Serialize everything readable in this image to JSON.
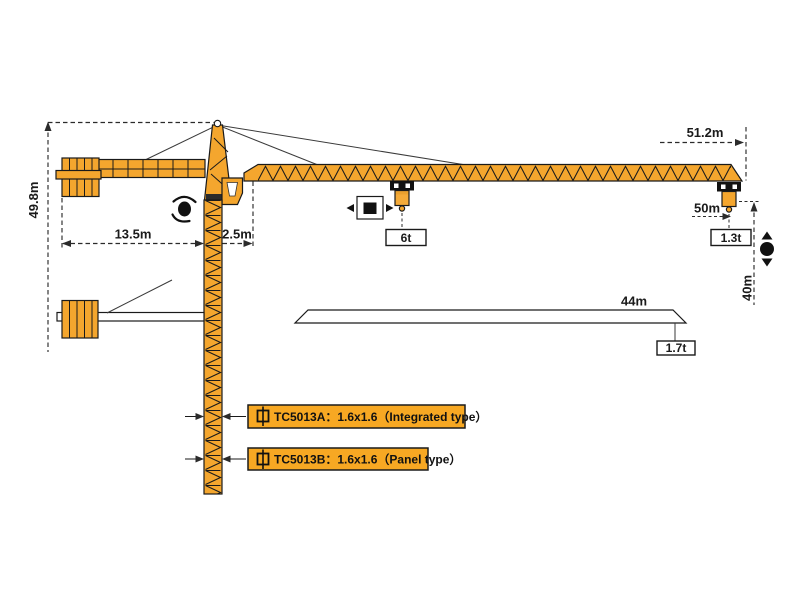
{
  "colors": {
    "crane": "#F4A62E",
    "outline": "#1A1A1A",
    "dim": "#2B2B2B",
    "label_bg": "#F7A823"
  },
  "dimensions": {
    "total_height": "49.8m",
    "counter_jib_length": "13.5m",
    "rear_offset": "2.5m",
    "jib_radius": "51.2m",
    "hook_radius": "50m",
    "hook_height": "40m",
    "alt_jib_length": "44m"
  },
  "loads": {
    "max_load": "6t",
    "tip_load": "1.3t",
    "alt_tip_load": "1.7t"
  },
  "mast_labels": {
    "type_a": "TC5013A：1.6x1.6（Integrated type）",
    "type_b": "TC5013B：1.6x1.6（Panel type）"
  }
}
